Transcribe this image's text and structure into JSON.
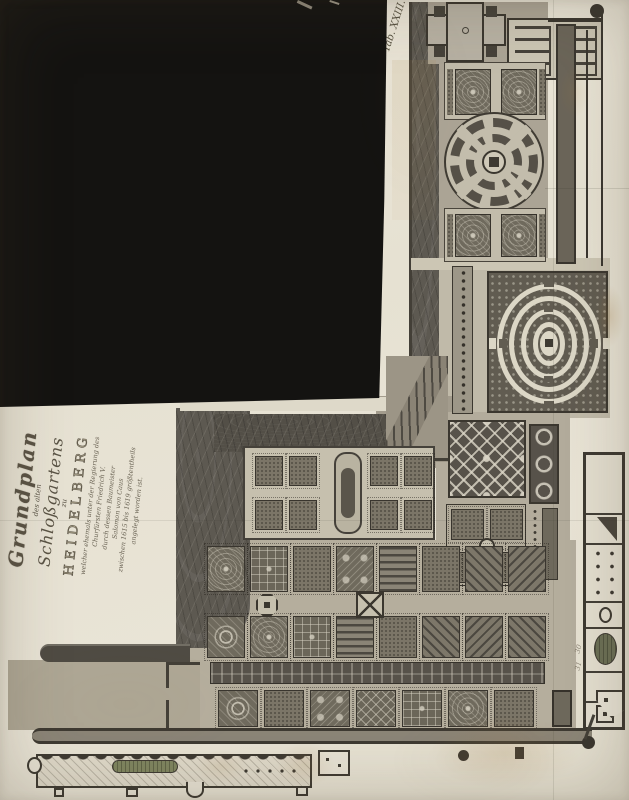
{
  "document": {
    "plate_label": "Tab. XXIII."
  },
  "cartouche": {
    "title_line": "Grundplan",
    "subtitle_small_1": "des alten",
    "title_script": "Schloßgartens",
    "subtitle_small_2": "zu",
    "title_caps": "HEIDELBERG",
    "dedication_lines": [
      "welcher ehemals unter der Regierung des",
      "Churfürsten Friedrich V.",
      "durch dessen Baumeister",
      "Salomon von Caus",
      "zwischen 1615 bis 1619 größtentheils",
      "angelegt worden ist."
    ]
  },
  "annotations": {
    "terrace_number_1": "30",
    "terrace_number_2": "31"
  },
  "colors": {
    "paper": "#eae5d8",
    "mask-black": "#141311",
    "ink": "#3c3831",
    "wall": "#433f37",
    "terrace": "#aba495",
    "terrace-light": "#c6c0ae",
    "bed-dark": "#6e695c",
    "hill": "#5d5951",
    "pool-green": "#7f8560",
    "ink-text": "#5a5345"
  },
  "garden": {
    "parterre_rows": [
      {
        "left": 207,
        "top": 546,
        "height": 46,
        "cell_width": 38,
        "gap": 5,
        "patterns": [
          "embroidery",
          "knot",
          "speckle",
          "quatrefoil",
          "stripes",
          "speckle",
          "diag",
          "diag2"
        ]
      },
      {
        "left": 207,
        "top": 616,
        "height": 42,
        "cell_width": 38,
        "gap": 5,
        "patterns": [
          "rosette",
          "embroidery",
          "knot",
          "stripes",
          "speckle",
          "diag",
          "diag2",
          "diag"
        ]
      },
      {
        "left": 218,
        "top": 690,
        "height": 37,
        "cell_width": 40,
        "gap": 6,
        "patterns": [
          "rosette",
          "speckle",
          "quatrefoil",
          "lozenge",
          "knot",
          "embroidery",
          "speckle"
        ]
      }
    ]
  }
}
